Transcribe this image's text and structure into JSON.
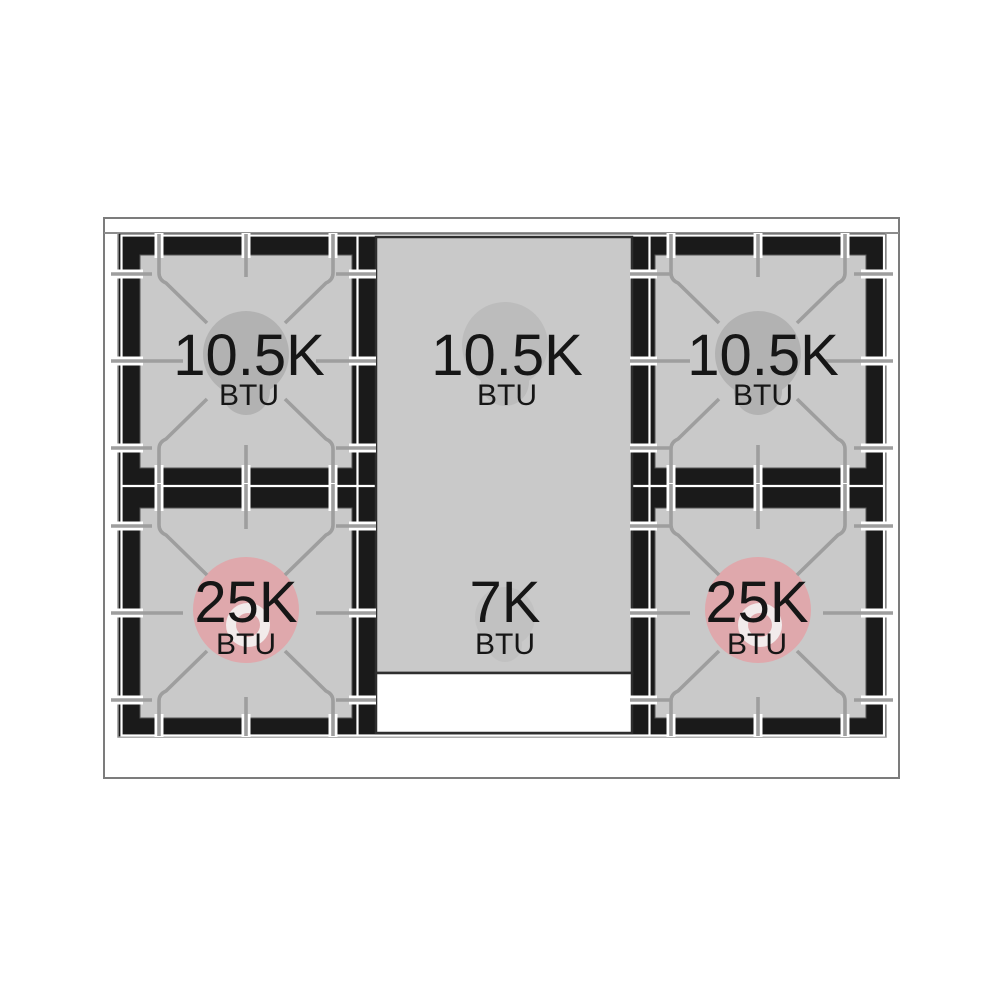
{
  "page": {
    "background": "#ffffff"
  },
  "cooktop": {
    "description": "Gas range cooktop burner BTU diagram, 2 sealed burners left, center griddle with 2 burners, 2 sealed burners right",
    "outer_border_color": "#7c7c7c",
    "edge_line_color": "#8c8c8c",
    "surface_color": "#1a1a1a",
    "surface_outline_color": "#949494",
    "grate_gap_color": "#ffffff",
    "burner_area_color": "#c9c9c9",
    "griddle_color": "#c9c9c9",
    "griddle_border_color": "#2e2e2e",
    "drip_tray_color": "#ffffff",
    "grate_line_color": "#9e9e9e",
    "grate_highlight_color": "#ffffff",
    "label_color": "#161616"
  },
  "burners": [
    {
      "id": "top-left",
      "value": "10.5K",
      "unit": "BTU",
      "style": "sealed",
      "cap_color": "#b2b2b2"
    },
    {
      "id": "top-center",
      "value": "10.5K",
      "unit": "BTU",
      "style": "griddle",
      "cap_color": "#bcbcbc"
    },
    {
      "id": "top-right",
      "value": "10.5K",
      "unit": "BTU",
      "style": "sealed",
      "cap_color": "#b2b2b2"
    },
    {
      "id": "bottom-left",
      "value": "25K",
      "unit": "BTU",
      "style": "power",
      "cap_color": "#dfa8ac",
      "ring_color": "#f2ebeb"
    },
    {
      "id": "bottom-center",
      "value": "7K",
      "unit": "BTU",
      "style": "griddle",
      "cap_color": "#c1c1c1"
    },
    {
      "id": "bottom-right",
      "value": "25K",
      "unit": "BTU",
      "style": "power",
      "cap_color": "#dfa8ac",
      "ring_color": "#f2ebeb"
    }
  ]
}
